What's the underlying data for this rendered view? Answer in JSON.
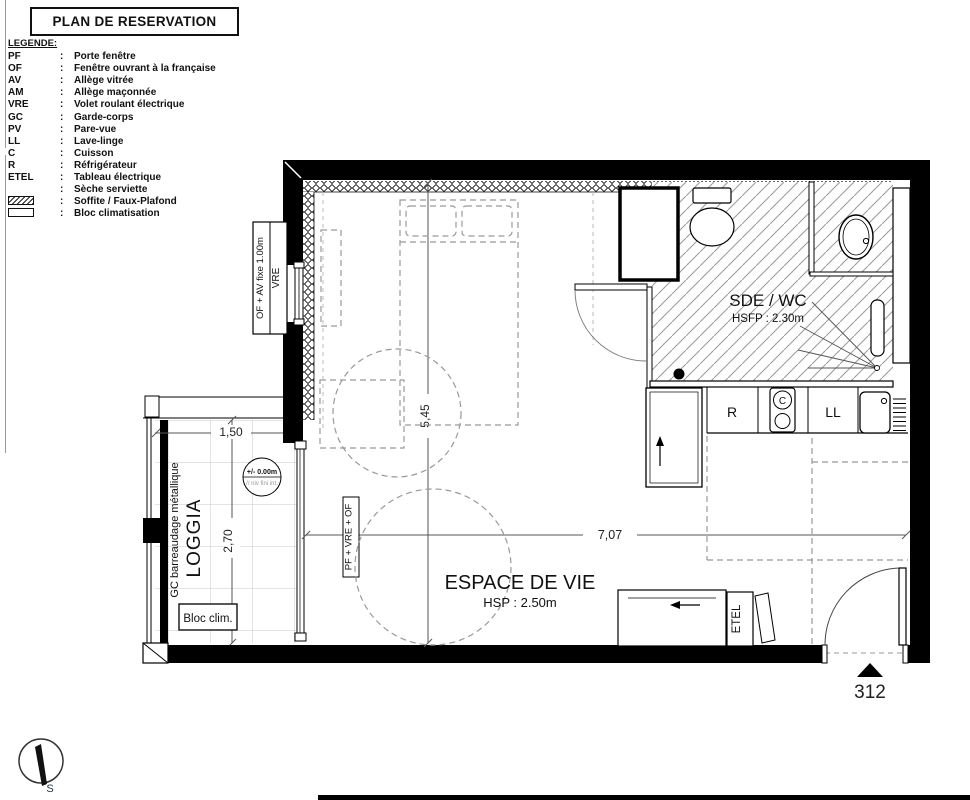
{
  "title": "PLAN DE RESERVATION",
  "legend": {
    "heading": "LEGENDE:",
    "colon": ":",
    "items": [
      {
        "code": "PF",
        "desc": "Porte fenêtre"
      },
      {
        "code": "OF",
        "desc": "Fenêtre ouvrant à la française"
      },
      {
        "code": "AV",
        "desc": "Allège vitrée"
      },
      {
        "code": "AM",
        "desc": "Allège maçonnée"
      },
      {
        "code": "VRE",
        "desc": "Volet roulant électrique"
      },
      {
        "code": "GC",
        "desc": "Garde-corps"
      },
      {
        "code": "PV",
        "desc": "Pare-vue"
      },
      {
        "code": "LL",
        "desc": "Lave-linge"
      },
      {
        "code": "C",
        "desc": "Cuisson"
      },
      {
        "code": "R",
        "desc": "Réfrigérateur"
      },
      {
        "code": "ETEL",
        "desc": "Tableau électrique"
      }
    ],
    "symbol_items": [
      {
        "symbol": "dot",
        "desc": "Sèche serviette"
      },
      {
        "symbol": "hatch",
        "desc": "Soffite / Faux-Plafond"
      },
      {
        "symbol": "box",
        "desc": "Bloc climatisation"
      }
    ]
  },
  "plan": {
    "rooms": {
      "sde": {
        "name": "SDE / WC",
        "ceiling": "HSFP : 2.30m"
      },
      "living": {
        "name": "ESPACE DE VIE",
        "ceiling": "HSP : 2.50m"
      },
      "loggia": {
        "name": "LOGGIA",
        "railing": "GC barreaudage métallique",
        "bloc_clim": "Bloc clim.",
        "level": "+/- 0.00m",
        "level_note": "// niv fini int."
      }
    },
    "dimensions": {
      "loggia_width": "1,50",
      "loggia_depth": "2,70",
      "room_depth": "5,45",
      "room_width": "7,07"
    },
    "openings": {
      "window_label": "OF + AV fixe 1.00m",
      "window_label2": "VRE",
      "loggia_door_label": "PF + VRE + OF"
    },
    "appliances": {
      "fridge": "R",
      "hob": "C",
      "washer": "LL"
    },
    "electrical_label": "ETEL",
    "unit_number": "312",
    "compass_south": "S"
  }
}
